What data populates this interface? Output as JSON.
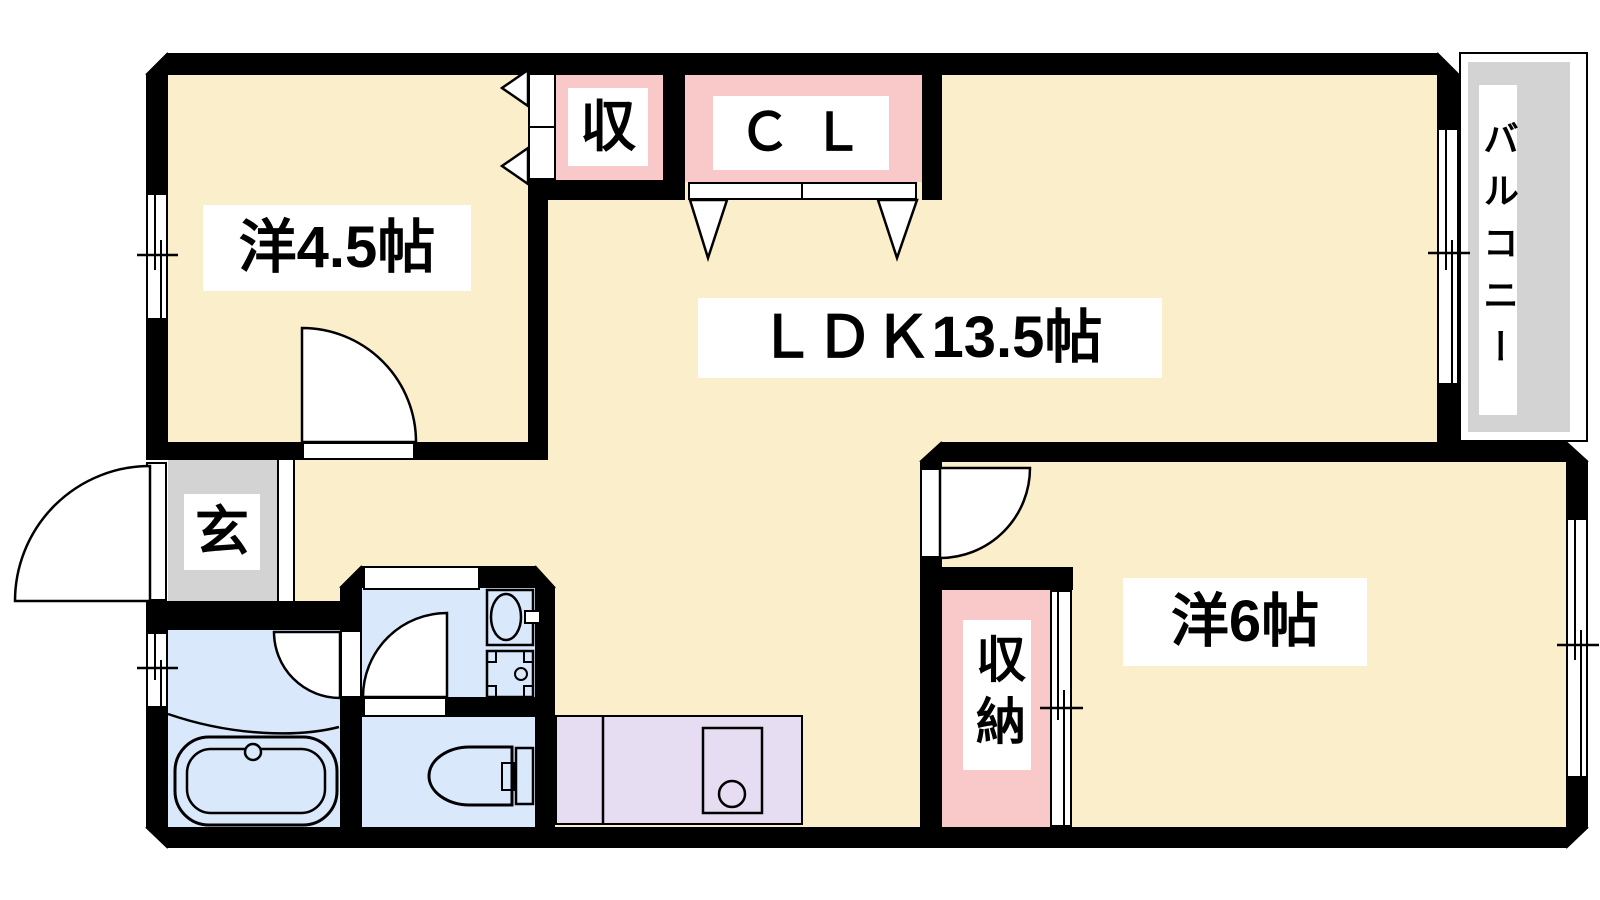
{
  "meta": {
    "type": "apartment floor plan"
  },
  "rooms": {
    "western45": {
      "label": "洋4.5帖"
    },
    "ldk": {
      "label": "ＬＤＫ13.5帖"
    },
    "western6": {
      "label": "洋6帖"
    },
    "storage_upper": {
      "label": "収"
    },
    "closet": {
      "label": "ＣＬ"
    },
    "entrance": {
      "label": "玄"
    },
    "storage_lower": {
      "label": "収納"
    },
    "balcony": {
      "label": "バルコニー"
    }
  },
  "colors": {
    "floor": "#faeecb",
    "closet_fill": "#f9c9c9",
    "entrance_fill": "#d3d3d3",
    "wet_area_fill": "#d9e8fa",
    "kitchen_fill": "#e6ddf3",
    "balcony_fill": "#d3d3d3",
    "wall": "#000000"
  },
  "fixtures": [
    "bathtub",
    "bath-faucet",
    "washbasin",
    "washing-machine-pan",
    "toilet",
    "kitchen-counter",
    "kitchen-sink",
    "sliding-window",
    "hinged-door",
    "folding-door",
    "sliding-closet-door"
  ]
}
